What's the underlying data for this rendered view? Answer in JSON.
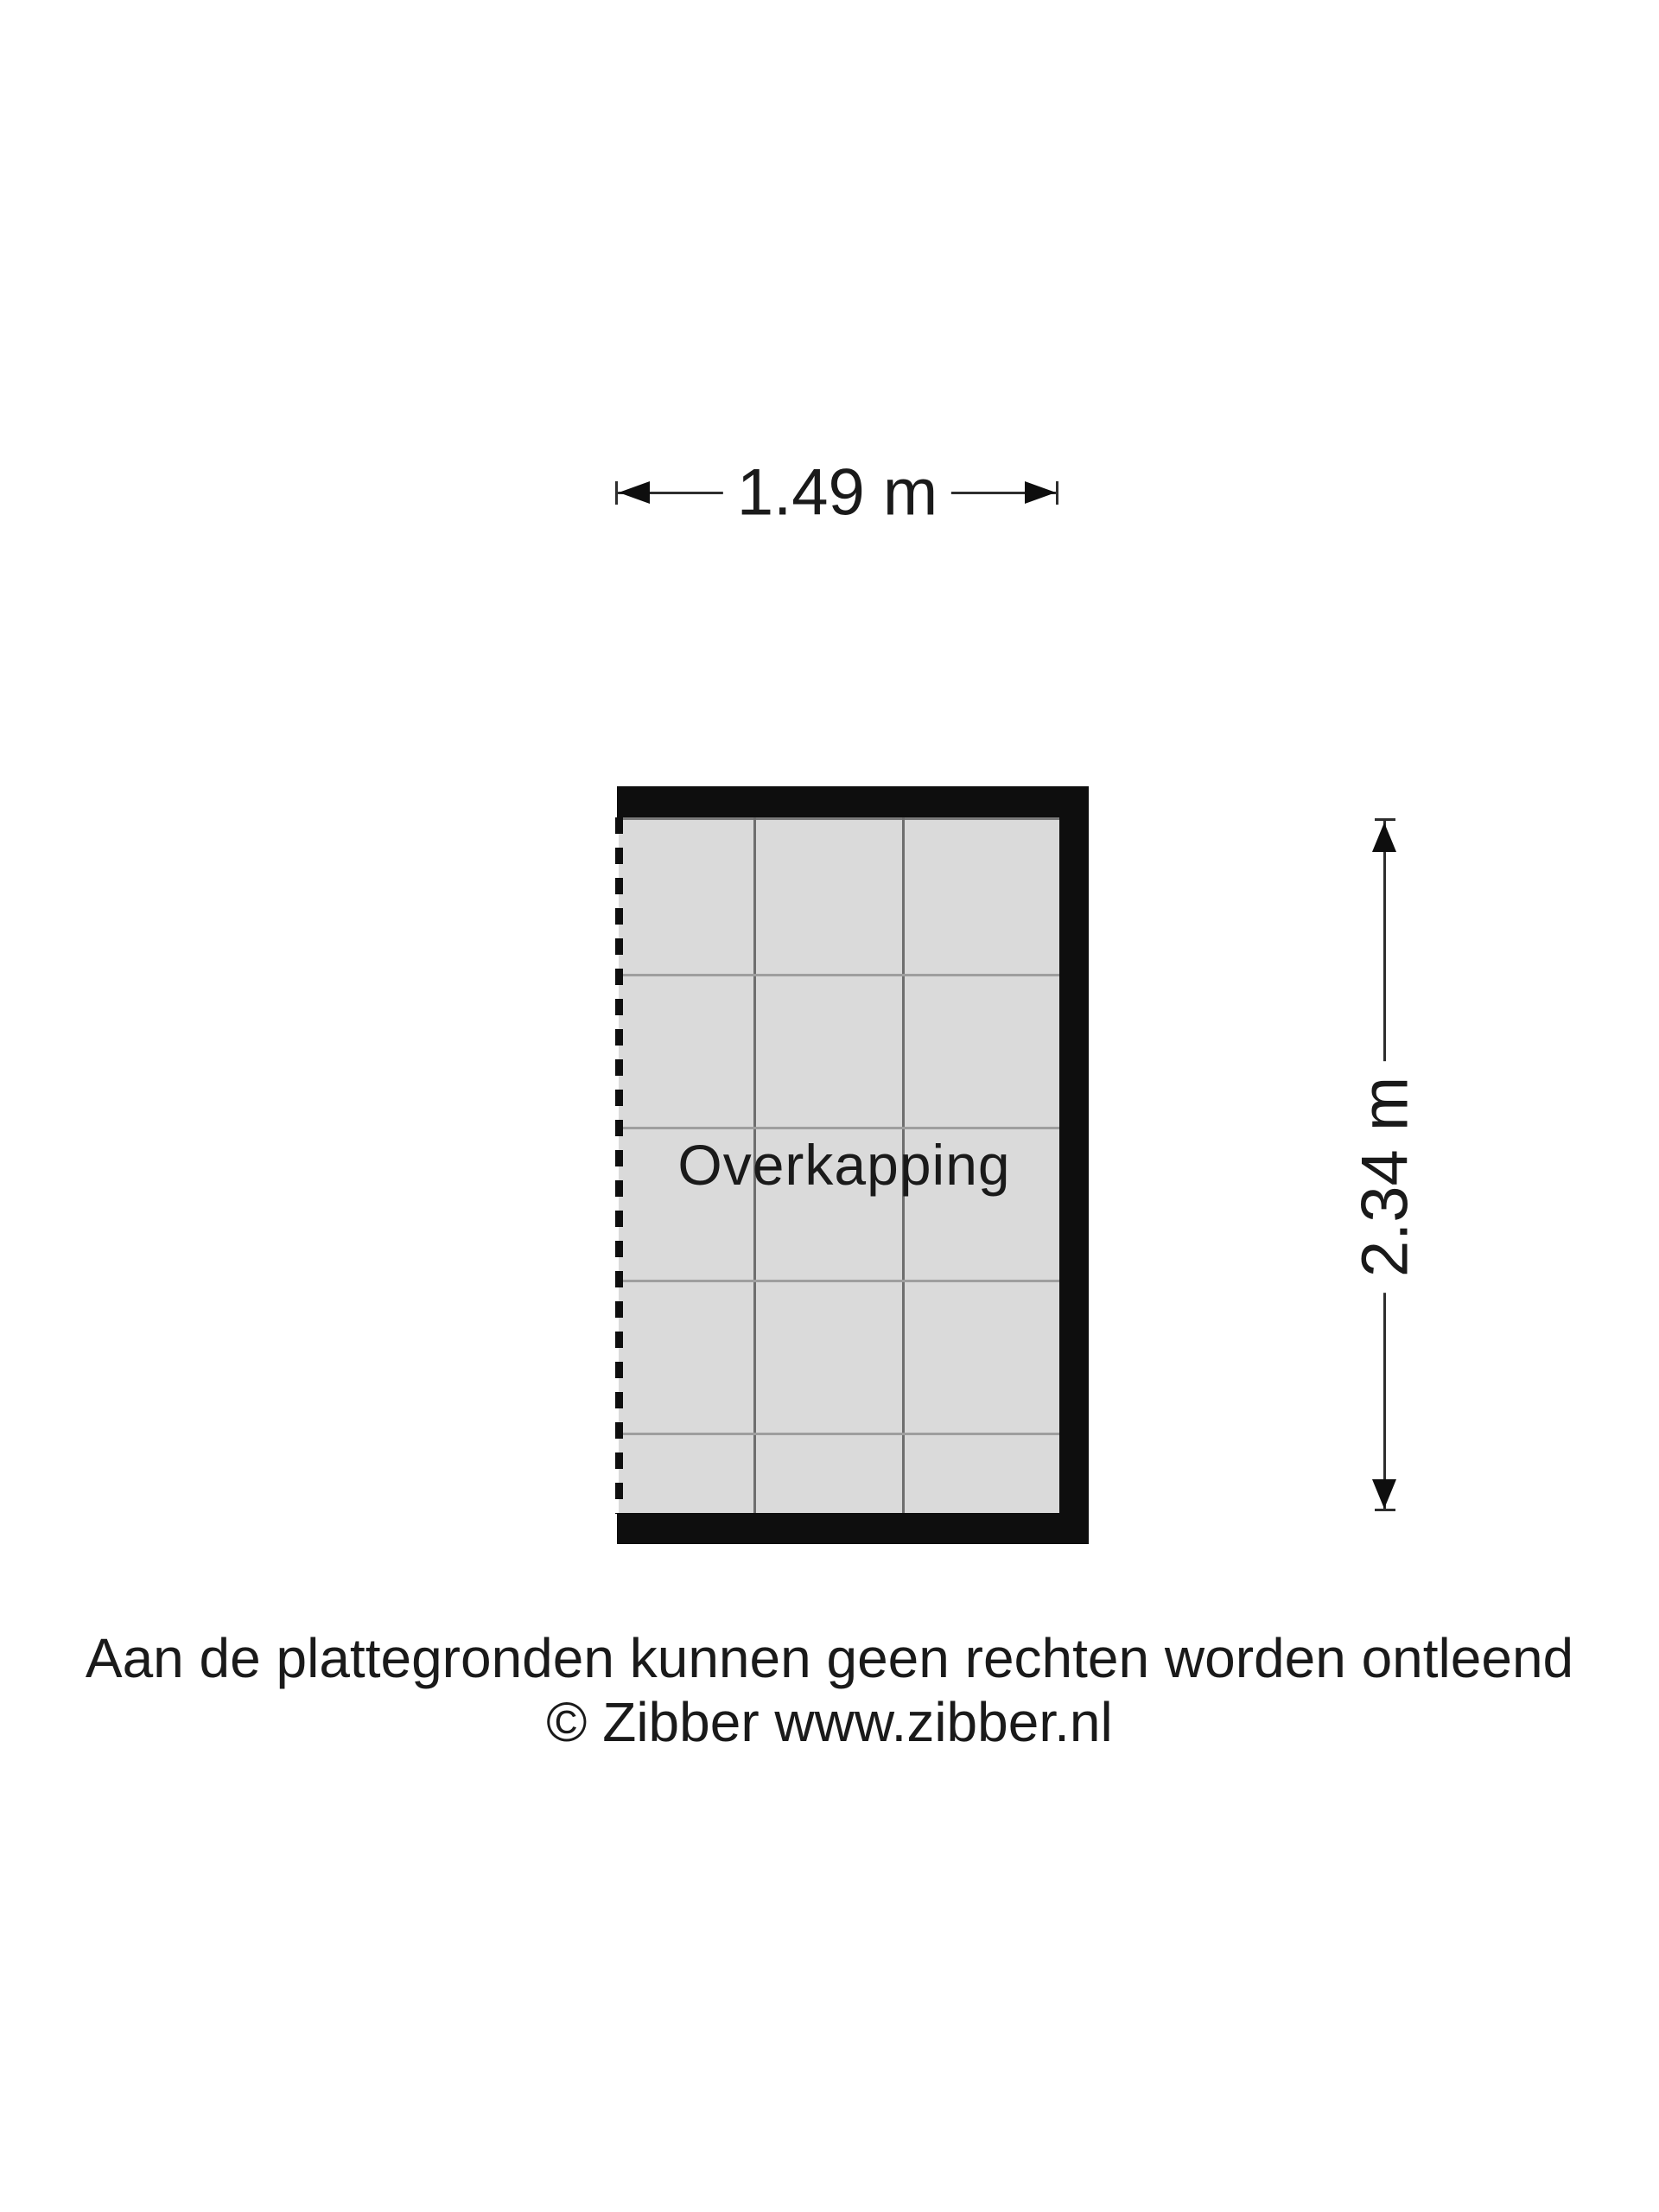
{
  "floorplan": {
    "room": {
      "label": "Overkapping",
      "width_label": "1.49 m",
      "height_label": "2.34 m"
    },
    "disclaimer_line1": "Aan de plattegronden kunnen geen rechten worden ontleend",
    "disclaimer_line2": "© Zibber www.zibber.nl",
    "colors": {
      "background": "#ffffff",
      "wall": "#0e0e0e",
      "floor_fill": "#dadada",
      "grid_line_vertical": "#6e6e6e",
      "grid_line_horizontal": "#9e9e9e",
      "dimension_line": "#2e2e2e",
      "text": "#1a1a1a"
    }
  }
}
